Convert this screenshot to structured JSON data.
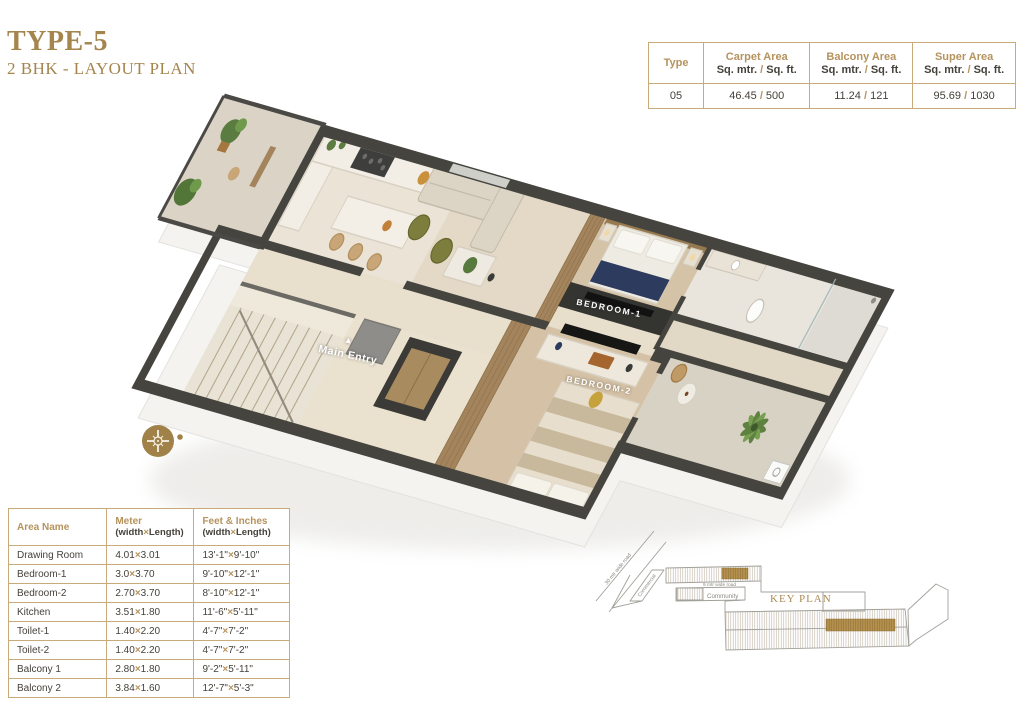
{
  "header": {
    "title": "TYPE-5",
    "subtitle": "2 BHK - LAYOUT PLAN"
  },
  "area_table": {
    "columns": [
      {
        "title": "Type",
        "subtitle": ""
      },
      {
        "title": "Carpet Area",
        "subtitle": "Sq. mtr. / Sq. ft."
      },
      {
        "title": "Balcony Area",
        "subtitle": "Sq. mtr. / Sq. ft."
      },
      {
        "title": "Super Area",
        "subtitle": "Sq. mtr. / Sq. ft."
      }
    ],
    "row": [
      "05",
      "46.45 / 500",
      "11.24 / 121",
      "95.69 / 1030"
    ]
  },
  "dimension_table": {
    "columns": [
      {
        "title": "Area Name",
        "subtitle": ""
      },
      {
        "title": "Meter",
        "subtitle": "(width×Length)"
      },
      {
        "title": "Feet & Inches",
        "subtitle": "(width×Length)"
      }
    ],
    "rows": [
      {
        "name": "Drawing Room",
        "meter": [
          "4.01",
          "3.01"
        ],
        "feet": [
          "13'-1\"",
          "9'-10\""
        ]
      },
      {
        "name": "Bedroom-1",
        "meter": [
          "3.0",
          "3.70"
        ],
        "feet": [
          "9'-10\"",
          "12'-1\""
        ]
      },
      {
        "name": "Bedroom-2",
        "meter": [
          "2.70",
          "3.70"
        ],
        "feet": [
          "8'-10\"",
          "12'-1\""
        ]
      },
      {
        "name": "Kitchen",
        "meter": [
          "3.51",
          "1.80"
        ],
        "feet": [
          "11'-6\"",
          "5'-11\""
        ]
      },
      {
        "name": "Toilet-1",
        "meter": [
          "1.40",
          "2.20"
        ],
        "feet": [
          "4'-7\"",
          "7'-2\""
        ]
      },
      {
        "name": "Toilet-2",
        "meter": [
          "1.40",
          "2.20"
        ],
        "feet": [
          "4'-7\"",
          "7'-2\""
        ]
      },
      {
        "name": "Balcony 1",
        "meter": [
          "2.80",
          "1.80"
        ],
        "feet": [
          "9'-2\"",
          "5'-11\""
        ]
      },
      {
        "name": "Balcony 2",
        "meter": [
          "3.84",
          "1.60"
        ],
        "feet": [
          "12'-7\"",
          "5'-3\""
        ]
      }
    ]
  },
  "plan": {
    "labels": {
      "main_entry": "Main Entry",
      "entry_arrow": "▲",
      "bedroom1": "BEDROOM-1",
      "bedroom2": "BEDROOM-2"
    }
  },
  "key_plan": {
    "title": "KEY PLAN",
    "road30": "30 mtr wide road",
    "road9": "9 mtr wide road",
    "community": "Community",
    "commercial": "Commercial"
  },
  "colors": {
    "gold": "#a5854e",
    "table_gold": "#b5935d",
    "wall": "#45443f",
    "navy": "#2d3c5e",
    "plant_green": "#5e8140"
  }
}
